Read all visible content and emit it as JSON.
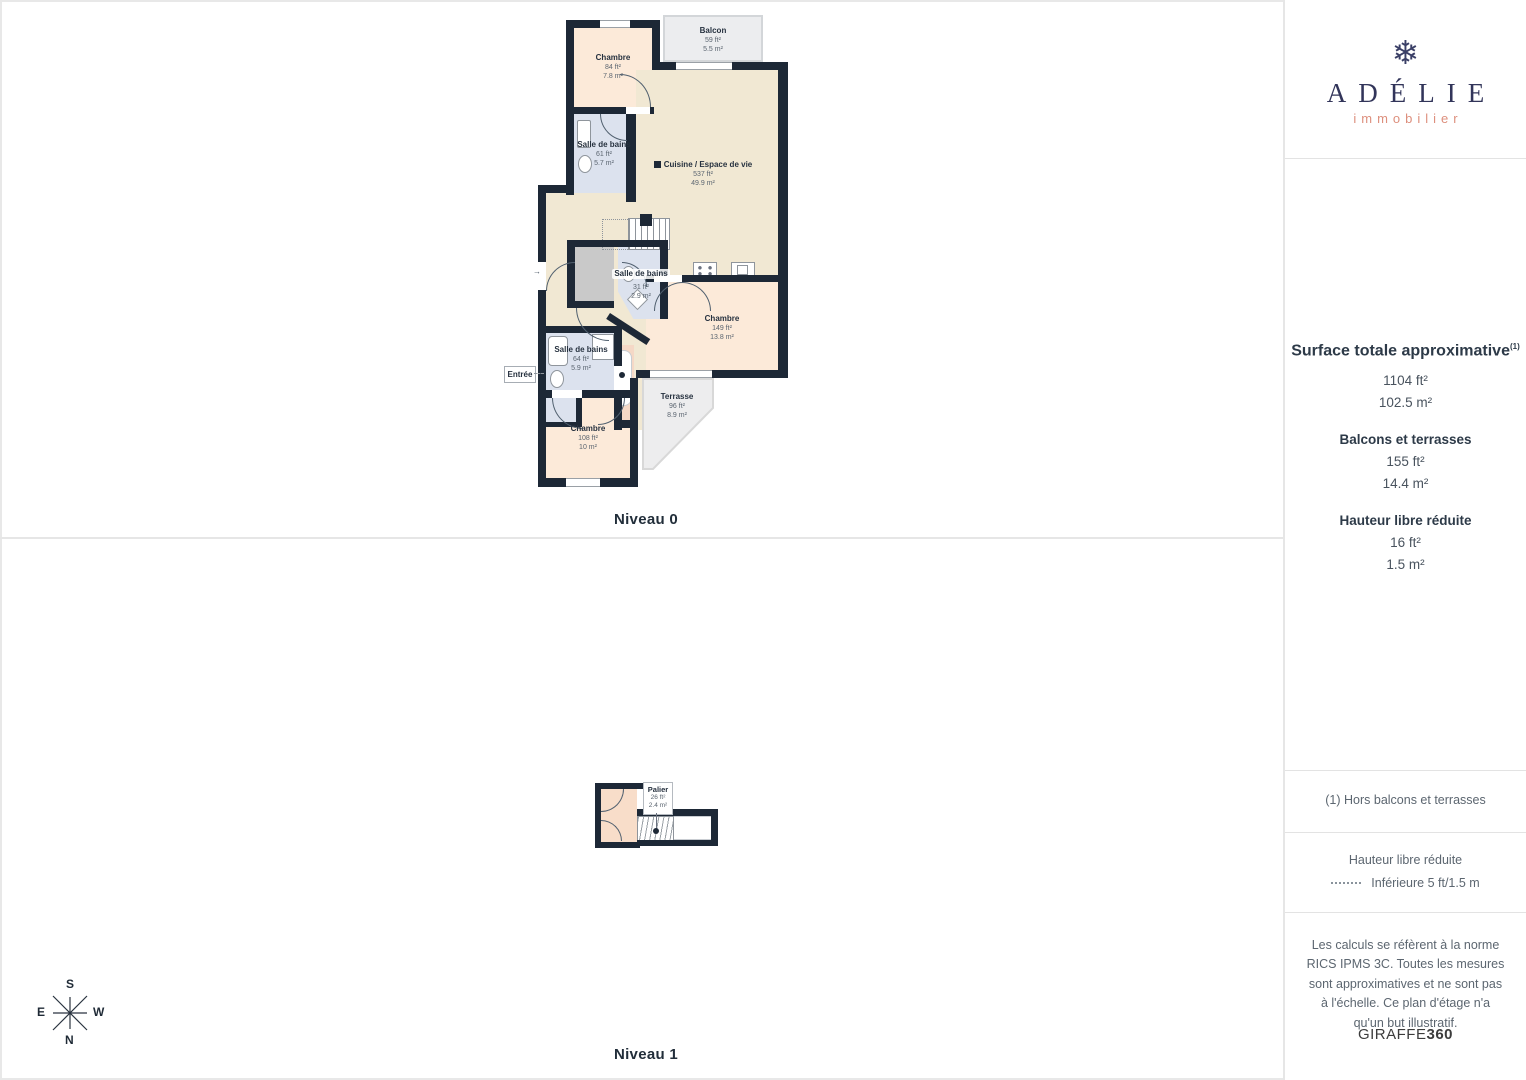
{
  "plan": {
    "niveau0_label": "Niveau 0",
    "niveau1_label": "Niveau 1",
    "entree_label": "Entrée",
    "niveau0": {
      "chambre_top": {
        "name": "Chambre",
        "ft": "84 ft²",
        "m": "7.8 m²"
      },
      "sdb_top": {
        "name": "Salle de bains",
        "ft": "61 ft²",
        "m": "5.7 m²"
      },
      "balcon": {
        "name": "Balcon",
        "ft": "59 ft²",
        "m": "5.5 m²"
      },
      "cuisine": {
        "name": "Cuisine / Espace de vie",
        "ft": "537 ft²",
        "m": "49.9 m²"
      },
      "sdb_mid": {
        "name": "Salle de bains",
        "ft": "31 ft²",
        "m": "2.9 m²"
      },
      "chambre_right": {
        "name": "Chambre",
        "ft": "149 ft²",
        "m": "13.8 m²"
      },
      "sdb_low": {
        "name": "Salle de bains",
        "ft": "64 ft²",
        "m": "5.9 m²"
      },
      "chambre_bottom": {
        "name": "Chambre",
        "ft": "108 ft²",
        "m": "10 m²"
      },
      "terrasse": {
        "name": "Terrasse",
        "ft": "96 ft²",
        "m": "8.9 m²"
      }
    },
    "niveau1": {
      "palier": {
        "name": "Palier",
        "ft": "26 ft²",
        "m": "2.4 m²"
      }
    }
  },
  "compass": {
    "top": "S",
    "bottom": "N",
    "left": "E",
    "right": "W"
  },
  "sidebar": {
    "brand": {
      "snowflake": "❄",
      "name": "ADÉLIE",
      "tagline": "immobilier"
    },
    "surface": {
      "title": "Surface totale approximative",
      "mark": "(1)",
      "total_ft": "1104 ft²",
      "total_m": "102.5 m²",
      "balconies_title": "Balcons et terrasses",
      "balconies_ft": "155 ft²",
      "balconies_m": "14.4 m²",
      "reduced_title": "Hauteur libre réduite",
      "reduced_ft": "16 ft²",
      "reduced_m": "1.5 m²"
    },
    "footnote": "(1) Hors balcons et terrasses",
    "legend": {
      "title": "Hauteur libre réduite",
      "item": "Inférieure 5 ft/1.5 m"
    },
    "disclaimer": "Les calculs se réfèrent à la norme RICS IPMS 3C. Toutes les mesures sont approximatives et ne sont pas à l'échelle. Ce plan d'étage n'a qu'un but illustratif.",
    "credit": {
      "brand": "GIRAFFE",
      "suffix": "360"
    }
  },
  "colors": {
    "wall": "#1d2836",
    "room_peach": "#fcead9",
    "room_peach_dark": "#f5d8c6",
    "room_blue": "#dce2ee",
    "room_beige": "#f1e8d3",
    "terrace_gray": "#ededee",
    "closet_gray": "#c9c9c9",
    "brand_navy": "#32355a",
    "brand_salmon": "#dd8f7d",
    "divider": "#e6e6e6"
  }
}
